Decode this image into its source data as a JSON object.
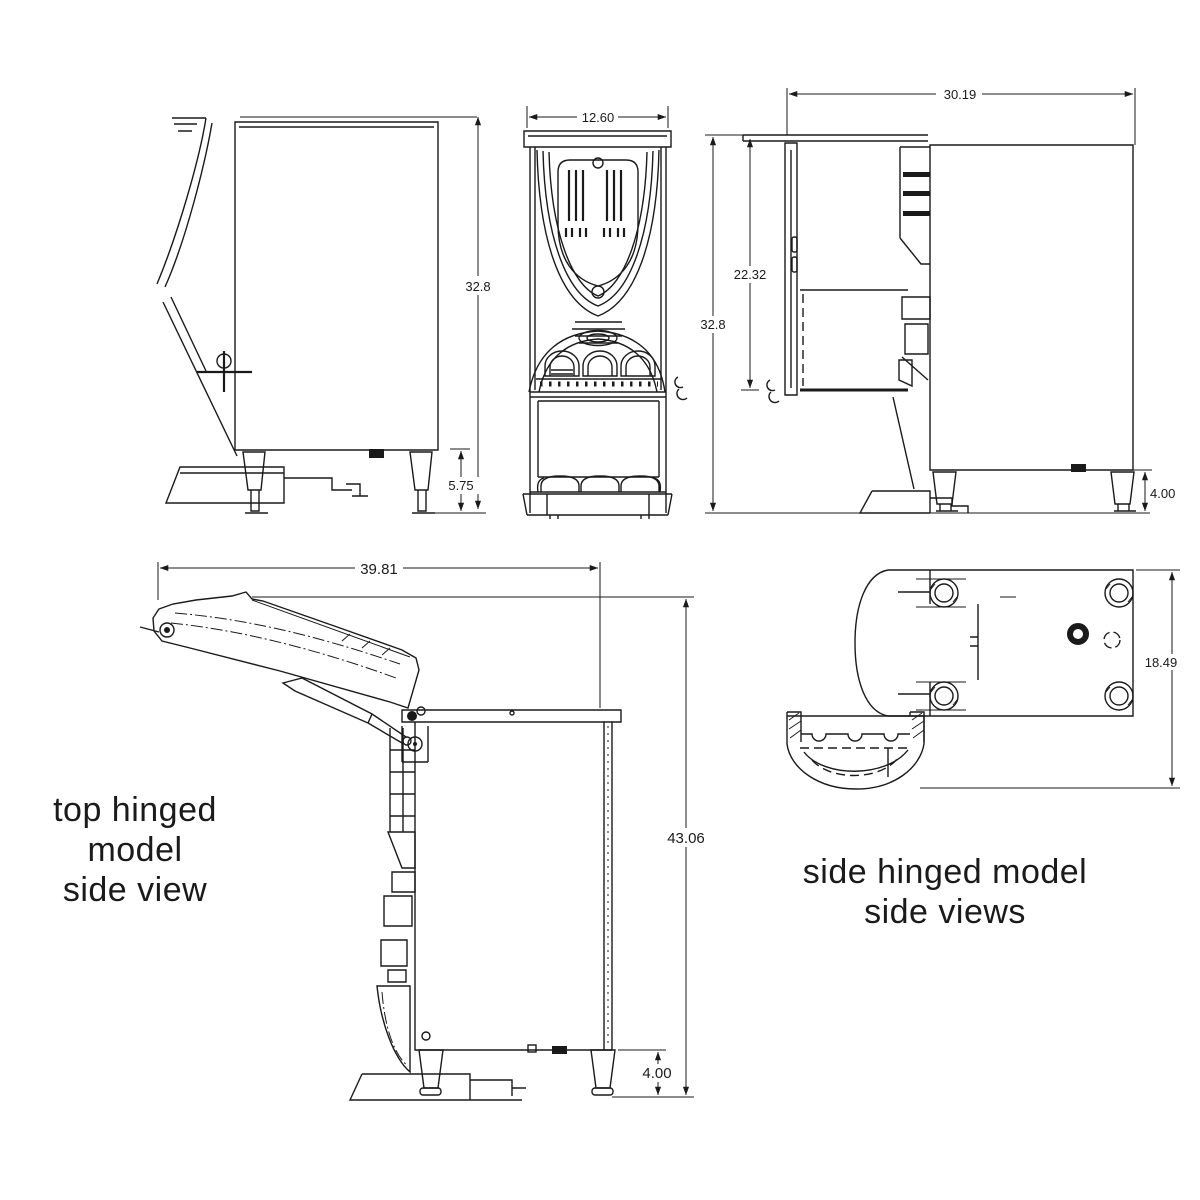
{
  "page": {
    "background": "#ffffff",
    "ink": "#1a1a1a"
  },
  "captions": {
    "top_hinged": {
      "line1": "top hinged model",
      "line2": "side view"
    },
    "side_hinged": {
      "line1": "side hinged model",
      "line2": "side views"
    }
  },
  "dimensions": {
    "side_view_closed": {
      "overall_height": "32.8",
      "leg_height": "5.75"
    },
    "front_view": {
      "overall_width": "12.60"
    },
    "side_view_open_door": {
      "overall_depth": "30.19",
      "door_opening_height": "22.32",
      "overall_height": "32.8",
      "leg_height": "4.00"
    },
    "top_hinged_view": {
      "depth_lid_open": "39.81",
      "height_lid_open": "43.06",
      "leg_height": "4.00"
    },
    "top_view": {
      "overall_depth": "18.49"
    }
  }
}
